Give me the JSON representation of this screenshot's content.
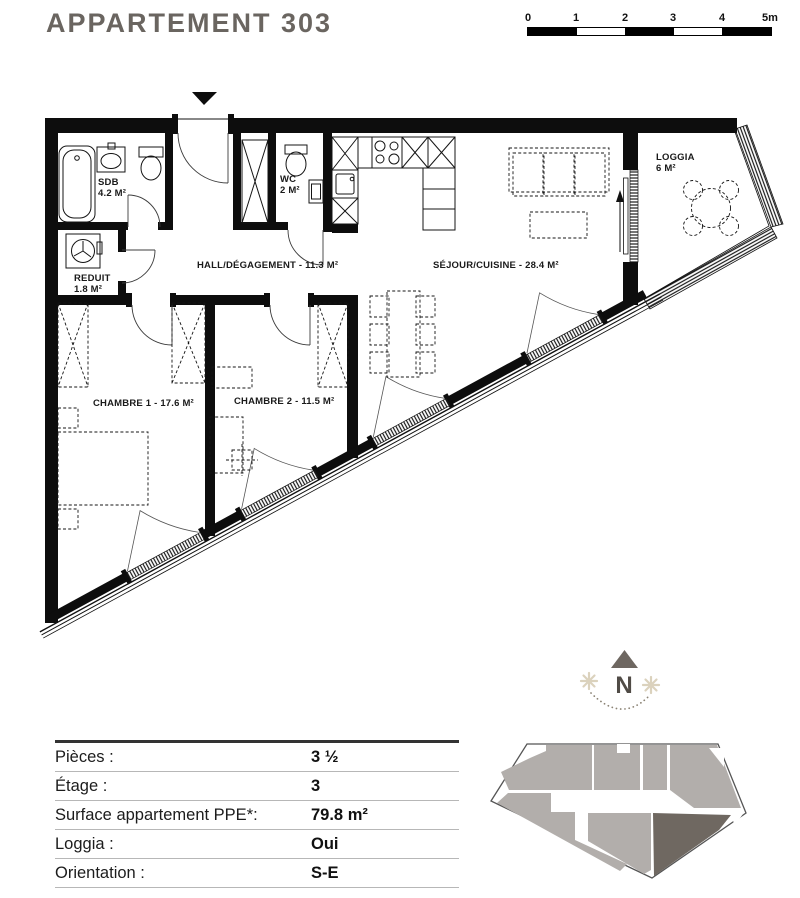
{
  "title": "APPARTEMENT 303",
  "scale_bar": {
    "unit_labels": [
      "0",
      "1",
      "2",
      "3",
      "4",
      "5m"
    ]
  },
  "plan": {
    "rooms": {
      "sdb": {
        "name": "SDB",
        "area": "4.2 M²"
      },
      "wc": {
        "name": "WC",
        "area": "2 M²"
      },
      "reduit": {
        "name": "REDUIT",
        "area": "1.8 M²"
      },
      "hall": {
        "label": "HALL/DÉGAGEMENT - 11.3 M²"
      },
      "sejour": {
        "label": "SÉJOUR/CUISINE - 28.4 M²"
      },
      "loggia": {
        "name": "LOGGIA",
        "area": "6 M²"
      },
      "chambre1": {
        "label": "CHAMBRE 1 - 17.6 M²"
      },
      "chambre2": {
        "label": "CHAMBRE 2 - 11.5 M²"
      }
    }
  },
  "compass": {
    "label": "N"
  },
  "details_table": {
    "rows": [
      {
        "label": "Pièces :",
        "value": "3 ½"
      },
      {
        "label": "Étage :",
        "value": "3"
      },
      {
        "label": "Surface appartement PPE*:",
        "value": "79.8 m²"
      },
      {
        "label": "Loggia :",
        "value": "Oui"
      },
      {
        "label": "Orientation :",
        "value": "S-E"
      }
    ]
  },
  "key_plan": {
    "unit_color": "#B2AEAB",
    "highlight_color": "#6F6861"
  }
}
